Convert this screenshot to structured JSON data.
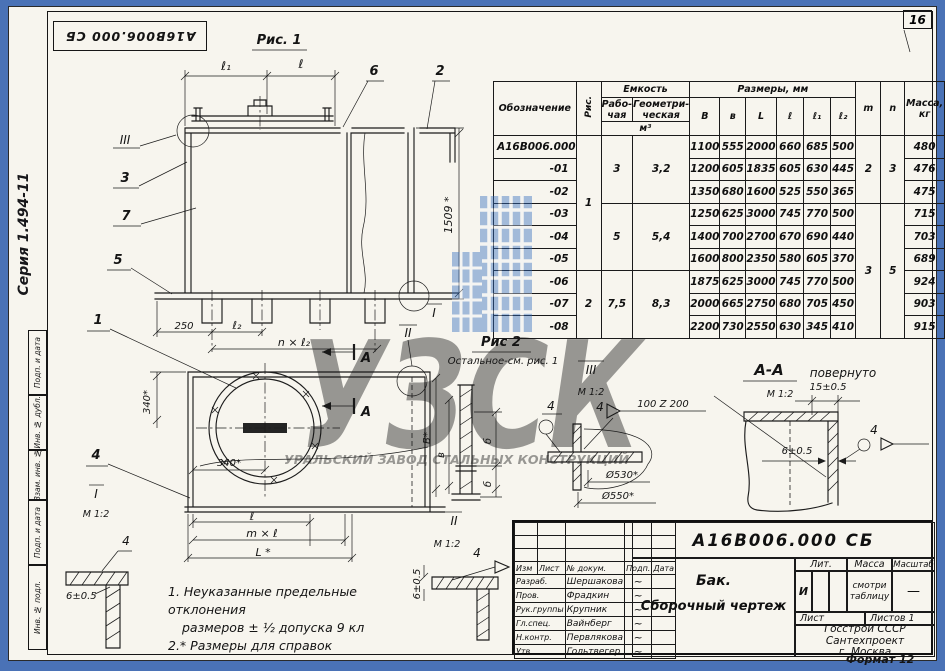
{
  "sheet": {
    "number": "16",
    "series": "Серия 1.494-11",
    "stamp": "А16В006.000 СБ",
    "format": "Формат 12"
  },
  "margin": {
    "s1": "Подп. и дата",
    "s2": "Инв. № дубл.",
    "s3": "Взам. инв. №",
    "s4": "Подп. и дата",
    "s5": "Инв. № подл."
  },
  "fig1": {
    "title": "Рис. 1",
    "l1": "ℓ₁",
    "l": "ℓ",
    "h": "1509 *",
    "d250": "250",
    "l2": "ℓ₂",
    "nl2": "n × ℓ₂",
    "c1": "1",
    "c2": "2",
    "c3": "3",
    "c5": "5",
    "c6": "6",
    "c7": "7",
    "view_iii": "III",
    "view_i": "I",
    "view_ii": "II"
  },
  "fig2": {
    "title": "Рис 2",
    "subtitle": "Остальное-см. рис. 1",
    "d340v": "340*",
    "d340h": "340*",
    "B": "В*",
    "v": "в",
    "b1": "б",
    "b2": "б",
    "l": "ℓ",
    "ml": "m × ℓ",
    "L": "L *",
    "c4": "4",
    "a1": "А",
    "a2": "А"
  },
  "views": {
    "i": {
      "label": "I",
      "scale": "М 1:2",
      "dim": "6±0.5",
      "weld": "4"
    },
    "ii": {
      "label": "II",
      "scale": "М 1:2",
      "dim": "6±0.5",
      "weld": "4"
    },
    "iii": {
      "label": "III",
      "scale": "М 1:2",
      "weld_a": "4",
      "weld_b": "4",
      "spec": "100 Z 200",
      "dia1": "Ø530*",
      "dia2": "Ø550*"
    },
    "aa": {
      "label": "А-А",
      "suffix": "повернуто",
      "scale": "М 1:2",
      "dim15": "15±0.5",
      "dim6": "6±0.5",
      "weld": "4"
    }
  },
  "notes": {
    "l1": "1. Неуказанные предельные отклонения",
    "l2": "размеров ± ½ допуска 9 кл",
    "l3": "2.* Размеры для справок"
  },
  "table": {
    "h": {
      "obozn": "Обозначение",
      "ris": "Рис.",
      "emkost": "Емкость",
      "rab": "Рабо-чая",
      "geom": "Геометри-ческая",
      "m3": "м³",
      "razmery": "Размеры, мм",
      "B": "В",
      "v": "в",
      "L": "L",
      "l": "ℓ",
      "l1": "ℓ₁",
      "l2": "ℓ₂",
      "m": "m",
      "n": "n",
      "massa": "Масса, кг"
    },
    "merged": {
      "ris1": "1",
      "ris2": "2",
      "rab1": "3",
      "rab2": "5",
      "rab3": "7,5",
      "geom1": "3,2",
      "geom2": "5,4",
      "geom3": "8,3",
      "m1": "2",
      "m2": "3",
      "n1": "3",
      "n2": "5"
    },
    "rows": [
      {
        "name": "А16В006.000",
        "B": "1100",
        "v": "555",
        "L": "2000",
        "l": "660",
        "l1": "685",
        "l2": "500",
        "mass": "480"
      },
      {
        "name": "-01",
        "B": "1200",
        "v": "605",
        "L": "1835",
        "l": "605",
        "l1": "630",
        "l2": "445",
        "mass": "476"
      },
      {
        "name": "-02",
        "B": "1350",
        "v": "680",
        "L": "1600",
        "l": "525",
        "l1": "550",
        "l2": "365",
        "mass": "475"
      },
      {
        "name": "-03",
        "B": "1250",
        "v": "625",
        "L": "3000",
        "l": "745",
        "l1": "770",
        "l2": "500",
        "mass": "715"
      },
      {
        "name": "-04",
        "B": "1400",
        "v": "700",
        "L": "2700",
        "l": "670",
        "l1": "690",
        "l2": "440",
        "mass": "703"
      },
      {
        "name": "-05",
        "B": "1600",
        "v": "800",
        "L": "2350",
        "l": "580",
        "l1": "605",
        "l2": "370",
        "mass": "689"
      },
      {
        "name": "-06",
        "B": "1875",
        "v": "625",
        "L": "3000",
        "l": "745",
        "l1": "770",
        "l2": "500",
        "mass": "924"
      },
      {
        "name": "-07",
        "B": "2000",
        "v": "665",
        "L": "2750",
        "l": "680",
        "l1": "705",
        "l2": "450",
        "mass": "903"
      },
      {
        "name": "-08",
        "B": "2200",
        "v": "730",
        "L": "2550",
        "l": "630",
        "l1": "345",
        "l2": "410",
        "mass": "915"
      }
    ]
  },
  "titleblock": {
    "doc": "А16В006.000 СБ",
    "name1": "Бак.",
    "name2": "Сборочный чертеж",
    "cols": {
      "izm": "Изм",
      "list": "Лист",
      "doc": "№ докум.",
      "podp": "Подп.",
      "data": "Дата"
    },
    "sig": "~",
    "rows": [
      {
        "role": "Разраб.",
        "name": "Шершакова"
      },
      {
        "role": "Пров.",
        "name": "Фрадкин"
      },
      {
        "role": "Рук.группы",
        "name": "Крупник"
      },
      {
        "role": "Гл.спец.",
        "name": "Вайнберг"
      },
      {
        "role": "Н.контр.",
        "name": "Первлякова"
      },
      {
        "role": "Утв.",
        "name": "Гольтвегер"
      }
    ],
    "lit_h": "Лит.",
    "massa_h": "Масса",
    "scale_h": "Масштаб",
    "lit": "И",
    "massa": "смотри таблицу",
    "scale": "—",
    "list_h": "Лист",
    "listov_h": "Листов 1",
    "org1": "Госстрой СССР",
    "org2": "Сантехпроект",
    "org3": "г. Москва"
  },
  "watermark": {
    "letters": "УЗСК",
    "subtitle": "УРАЛЬСКИЙ ЗАВОД СТАЛЬНЫХ КОНСТРУКЦИЙ"
  },
  "colors": {
    "frame_blue": "#4a72b6",
    "paper": "#f7f5ee",
    "ink": "#1a1a1a",
    "watermark_blue": "#2e6abe"
  }
}
